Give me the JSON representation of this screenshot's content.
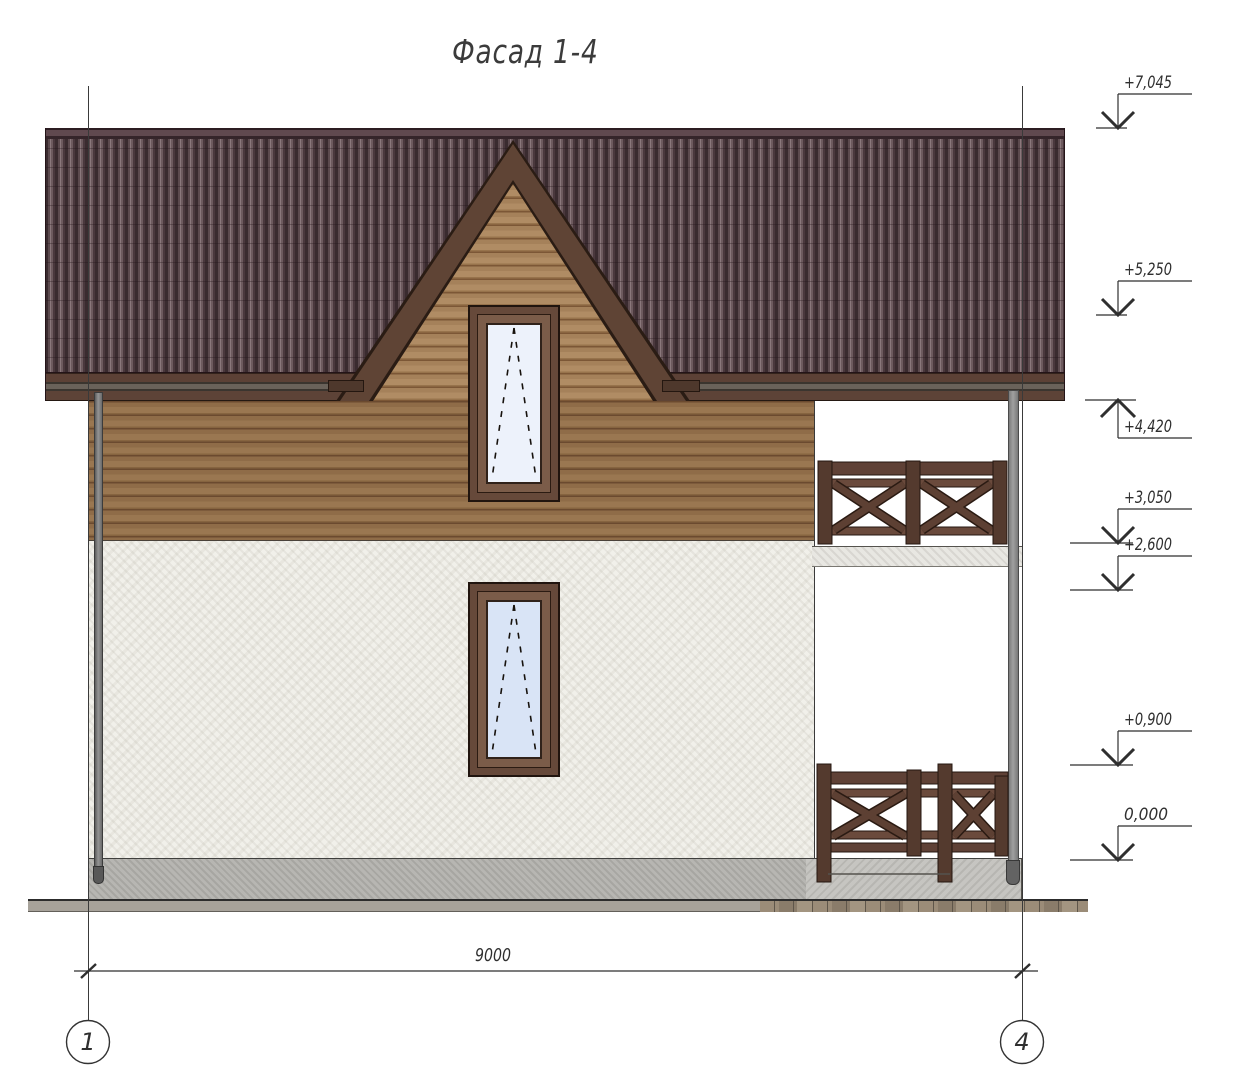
{
  "drawing": {
    "title": "Фасад 1-4",
    "type_label": "facade-elevation"
  },
  "dimension": {
    "overall_width": "9000"
  },
  "axes": [
    {
      "label": "1"
    },
    {
      "label": "4"
    }
  ],
  "elevation_marks": [
    {
      "label": "+7,045",
      "direction": "down",
      "feature": "roof-ridge"
    },
    {
      "label": "+5,250",
      "direction": "down",
      "feature": "roof-mid"
    },
    {
      "label": "+4,420",
      "direction": "up",
      "feature": "eave-underside"
    },
    {
      "label": "+3,050",
      "direction": "down",
      "feature": "balcony-floor"
    },
    {
      "label": "+2,600",
      "direction": "down",
      "feature": "first-floor-ceiling"
    },
    {
      "label": "+0,900",
      "direction": "down",
      "feature": "terrace-railing"
    },
    {
      "label": "0,000",
      "direction": "down",
      "feature": "ground-floor-level"
    }
  ],
  "colors": {
    "roof_tile_dark": "#3a2b2f",
    "roof_tile_light": "#8a777b",
    "fascia_brown": "#5c4136",
    "wood_wall": "#9a7751",
    "gable_siding": "#a5815a",
    "window_frame": "#66493a",
    "glass_attic": "#edf2fb",
    "glass_first": "#d9e4f6",
    "stucco": "#f1f0ea",
    "railing_wood": "#5f4136",
    "foundation_concrete": "#b7b6b2",
    "steel_gray": "#8a8a8a",
    "annotation_line": "#2f2f2f"
  }
}
